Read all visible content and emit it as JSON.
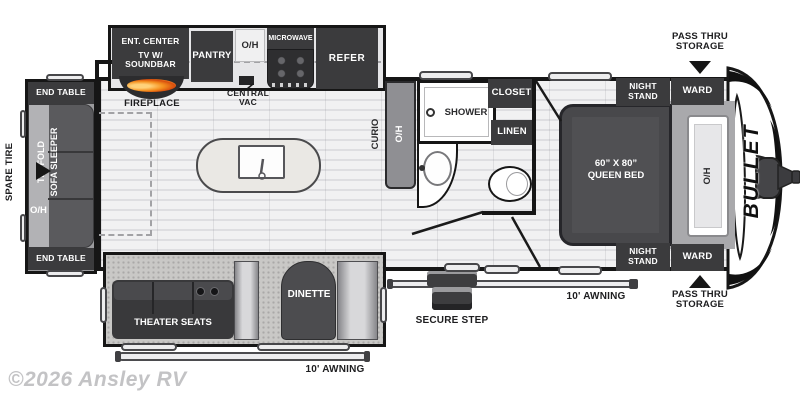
{
  "watermark": "©2026 Ansley RV",
  "logo_vertical": "BULLET",
  "colors": {
    "furniture_dark": "#3b3b3d",
    "flame_orange": "#f47b20",
    "wall": "#161616",
    "floor_light": "#efeff0",
    "carpet_gray": "#c9c8c6"
  },
  "exterior": {
    "spare_tire": "SPARE TIRE",
    "pass_thru_top": "PASS THRU STORAGE",
    "pass_thru_bottom": "PASS THRU STORAGE",
    "awning_rear": "10' AWNING",
    "awning_door": "10' AWNING",
    "secure_step": "SECURE STEP"
  },
  "rear_slide": {
    "end_table_top": "END TABLE",
    "end_table_bottom": "END TABLE",
    "sofa_line1": "TRI-FOLD",
    "sofa_line2": "SOFA SLEEPER",
    "sofa_overhead": "O/H"
  },
  "kitchen": {
    "ent_center_line1": "ENT. CENTER",
    "ent_center_line2": "TV W/",
    "ent_center_line3": "SOUNDBAR",
    "fireplace": "FIREPLACE",
    "pantry": "PANTRY",
    "overhead": "O/H",
    "microwave": "MICROWAVE",
    "refer": "REFER",
    "central_vac_line1": "CENTRAL",
    "central_vac_line2": "VAC",
    "curio": "CURIO",
    "curio_overhead": "O/H"
  },
  "bathroom": {
    "shower": "SHOWER",
    "closet": "CLOSET",
    "linen": "LINEN"
  },
  "bedroom": {
    "night_stand_top": "NIGHT STAND",
    "night_stand_bottom": "NIGHT STAND",
    "ward_top": "WARD",
    "ward_bottom": "WARD",
    "bed_size": "60” X 80”",
    "bed_name": "QUEEN BED",
    "headboard_overhead": "O/H"
  },
  "door_slide": {
    "theater_seats": "THEATER SEATS",
    "dinette": "DINETTE"
  }
}
